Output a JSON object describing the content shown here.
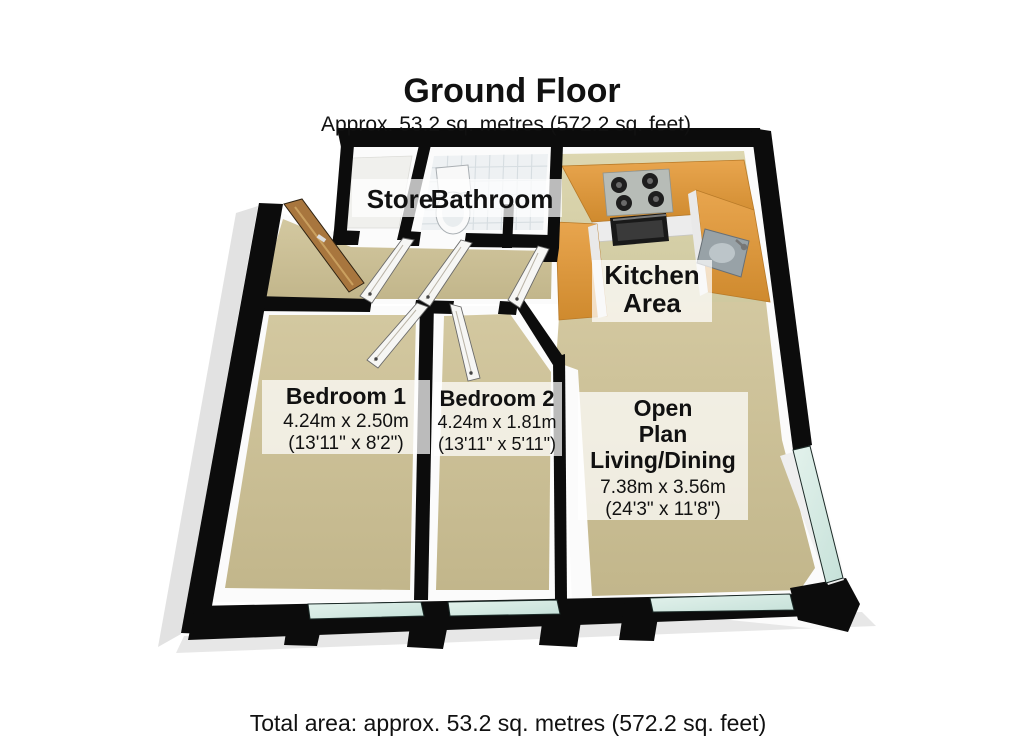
{
  "floorplan": {
    "title": "Ground Floor",
    "subtitle": "Approx. 53.2 sq. metres (572.2 sq. feet)",
    "footer": "Total area: approx. 53.2 sq. metres (572.2 sq. feet)",
    "rooms": {
      "store": {
        "name": "Store"
      },
      "bathroom": {
        "name": "Bathroom"
      },
      "kitchen": {
        "line1": "Kitchen",
        "line2": "Area"
      },
      "bedroom1": {
        "name": "Bedroom 1",
        "metric": "4.24m x 2.50m",
        "imperial": "(13'11\" x 8'2\")"
      },
      "bedroom2": {
        "name": "Bedroom 2",
        "metric": "4.24m x 1.81m",
        "imperial": "(13'11\" x 5'11\")"
      },
      "living": {
        "line1": "Open",
        "line2": "Plan",
        "line3": "Living/Dining",
        "metric": "7.38m x 3.56m",
        "imperial": "(24'3\" x 11'8\")"
      }
    },
    "colors": {
      "wall": "#0c0c0c",
      "carpet": "#cbbf96",
      "kitchen_floor": "#d7d1a9",
      "tile_floor": "#eef1f3",
      "counter": "#e0993f",
      "window_glass": "#d6ebe5",
      "front_door": "#a8763e",
      "label_background": "rgba(255,255,255,0.72)"
    }
  }
}
